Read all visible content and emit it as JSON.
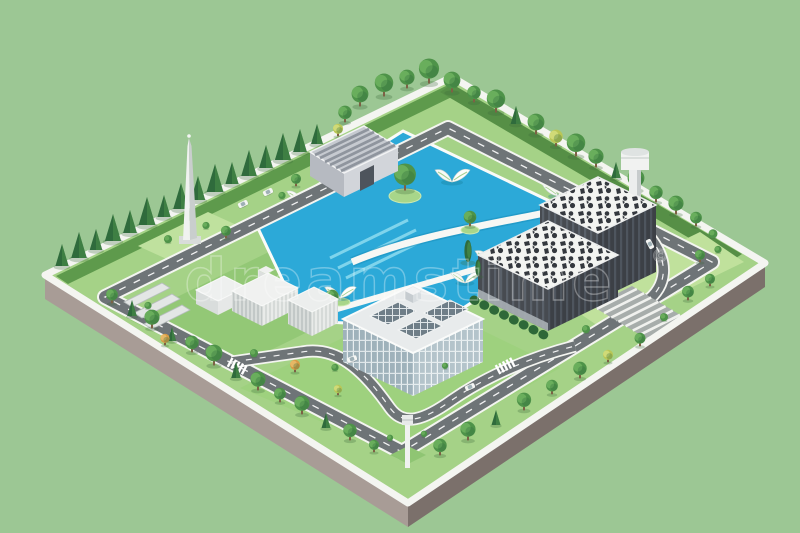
{
  "watermark": {
    "text": "dreamstime",
    "copyright": "©"
  },
  "palette": {
    "background": "#9cc794",
    "platform_side_left": "#a89c96",
    "platform_side_right": "#7b706b",
    "rim": "#f4f5f1",
    "grass_base": "#a5d287",
    "grass_dark": "#5e9a4c",
    "grass_light": "#bfe19e",
    "water": "#2ca9d8",
    "water_lane": "#8edcf0",
    "road": "#6e7477",
    "road_dash": "#ffffff",
    "roof_white": "#f3f4f1",
    "roof_speckle": "#34383e",
    "dark_wall": "#474b51",
    "glass_frame": "#e8ebec",
    "tree_dark": "#2f6b3c",
    "tree_mid": "#4e9349",
    "tree_light": "#6fb35f",
    "tree_accent": "#d79b45",
    "tree_accent_hi": "#e9bc6b",
    "tree_yellow": "#b9c656",
    "tree_yellow_hi": "#d3dd7d",
    "trunk": "#7d6145",
    "car_body": "#f5f6f4",
    "car_glass": "#9fb0b6",
    "watermark_color": "#ffffff"
  },
  "scene": {
    "back_trees": [
      [
        62,
        266,
        "c",
        22
      ],
      [
        79,
        258,
        "c",
        26
      ],
      [
        96,
        250,
        "c",
        21
      ],
      [
        113,
        241,
        "c",
        27
      ],
      [
        130,
        233,
        "c",
        23
      ],
      [
        147,
        225,
        "c",
        28
      ],
      [
        164,
        217,
        "c",
        22
      ],
      [
        181,
        209,
        "c",
        26
      ],
      [
        198,
        200,
        "c",
        24
      ],
      [
        215,
        192,
        "c",
        28
      ],
      [
        232,
        184,
        "c",
        22
      ],
      [
        249,
        176,
        "c",
        26
      ],
      [
        266,
        168,
        "c",
        23
      ],
      [
        283,
        160,
        "c",
        27
      ],
      [
        300,
        152,
        "c",
        23
      ],
      [
        317,
        144,
        "c",
        20
      ],
      [
        345,
        122,
        "r",
        16
      ],
      [
        360,
        106,
        "r",
        20
      ],
      [
        384,
        96,
        "r",
        22
      ],
      [
        407,
        88,
        "r",
        18
      ],
      [
        429,
        83,
        "r",
        24
      ],
      [
        338,
        136,
        "y",
        12
      ],
      [
        452,
        92,
        "r",
        20
      ],
      [
        474,
        102,
        "r",
        16
      ],
      [
        496,
        112,
        "r",
        22
      ],
      [
        516,
        124,
        "c",
        18
      ],
      [
        536,
        134,
        "r",
        20
      ],
      [
        556,
        146,
        "y",
        16
      ],
      [
        576,
        156,
        "r",
        22
      ],
      [
        596,
        167,
        "r",
        18
      ],
      [
        616,
        178,
        "c",
        16
      ],
      [
        636,
        190,
        "r",
        20
      ],
      [
        656,
        202,
        "r",
        16
      ],
      [
        676,
        214,
        "r",
        18
      ],
      [
        696,
        226,
        "r",
        14
      ],
      [
        713,
        237,
        "b",
        10
      ],
      [
        405,
        190,
        "r",
        26
      ],
      [
        470,
        226,
        "r",
        15
      ],
      [
        568,
        232,
        "r",
        16
      ],
      [
        590,
        252,
        "r",
        13
      ],
      [
        332,
        306,
        "r",
        16
      ],
      [
        168,
        242,
        "b",
        9
      ],
      [
        206,
        228,
        "b",
        8
      ],
      [
        226,
        238,
        "r",
        12
      ],
      [
        296,
        186,
        "r",
        12
      ],
      [
        282,
        198,
        "b",
        8
      ]
    ],
    "front_trees": [
      [
        112,
        303,
        "r",
        14
      ],
      [
        132,
        316,
        "c",
        16
      ],
      [
        152,
        328,
        "r",
        18
      ],
      [
        172,
        341,
        "c",
        14
      ],
      [
        192,
        352,
        "r",
        16
      ],
      [
        214,
        365,
        "r",
        20
      ],
      [
        236,
        378,
        "c",
        16
      ],
      [
        258,
        390,
        "r",
        18
      ],
      [
        280,
        402,
        "r",
        14
      ],
      [
        302,
        414,
        "r",
        18
      ],
      [
        326,
        428,
        "c",
        15
      ],
      [
        350,
        440,
        "r",
        16
      ],
      [
        374,
        452,
        "r",
        12
      ],
      [
        165,
        345,
        "a",
        11
      ],
      [
        295,
        372,
        "a",
        12
      ],
      [
        338,
        395,
        "y",
        10
      ],
      [
        148,
        308,
        "b",
        8
      ],
      [
        254,
        356,
        "b",
        9
      ],
      [
        390,
        440,
        "b",
        7
      ],
      [
        424,
        436,
        "b",
        7
      ],
      [
        440,
        455,
        "r",
        16
      ],
      [
        468,
        440,
        "r",
        18
      ],
      [
        496,
        425,
        "c",
        15
      ],
      [
        524,
        410,
        "r",
        17
      ],
      [
        552,
        394,
        "r",
        14
      ],
      [
        580,
        378,
        "r",
        16
      ],
      [
        608,
        362,
        "y",
        12
      ],
      [
        640,
        346,
        "r",
        13
      ],
      [
        688,
        300,
        "r",
        14
      ],
      [
        710,
        286,
        "r",
        12
      ],
      [
        664,
        320,
        "b",
        9
      ],
      [
        586,
        332,
        "b",
        9
      ],
      [
        335,
        370,
        "b",
        8
      ],
      [
        445,
        368,
        "b",
        7
      ],
      [
        468,
        262,
        "p",
        20
      ],
      [
        478,
        276,
        "p",
        15
      ],
      [
        700,
        262,
        "r",
        12
      ],
      [
        718,
        252,
        "b",
        8
      ]
    ],
    "cars": [
      [
        268,
        192,
        -26
      ],
      [
        243,
        204,
        -26
      ],
      [
        650,
        244,
        62
      ],
      [
        470,
        387,
        -24
      ],
      [
        352,
        359,
        -20
      ]
    ],
    "sails": [
      [
        373,
        176,
        1
      ],
      [
        302,
        202,
        0.9
      ],
      [
        452,
        182,
        1
      ],
      [
        558,
        196,
        0.9
      ],
      [
        492,
        263,
        1
      ],
      [
        340,
        298,
        0.9
      ],
      [
        465,
        283,
        0.85
      ]
    ]
  }
}
